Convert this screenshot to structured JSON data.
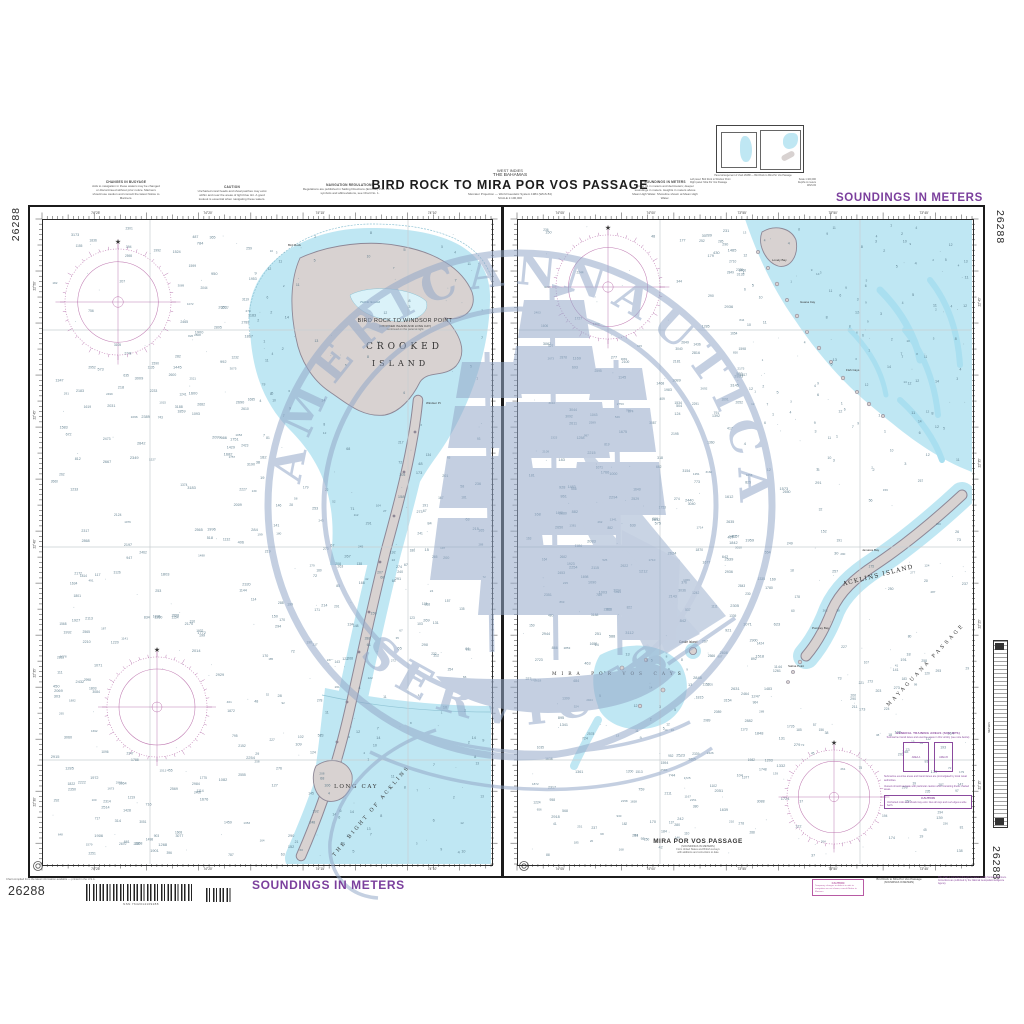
{
  "chart_number": "26288",
  "colors": {
    "accent": "#7b3f9d",
    "magenta": "#b85aa4",
    "roseline": "#c07bb2",
    "water": "#bfe7f3",
    "waterlight": "#daf2f9",
    "land": "#d8d2d1",
    "landedge": "#8d8796",
    "contour": "#8fc3d4",
    "sounding": "#4f7182",
    "wm": "#94a9c9",
    "graytext": "#555555"
  },
  "banner": {
    "soundings": "SOUNDINGS IN METERS"
  },
  "header": {
    "small1": "WEST INDIES",
    "small2": "THE BAHAMAS",
    "title": "BIRD ROCK TO MIRA POR VOS PASSAGE",
    "sub1": "Mercator Projection — World Geodetic System 1984 (WGS 84)",
    "sub2": "SCALE 1:100,000"
  },
  "notes_top": [
    {
      "title": "CHANGES IN BUOYAGE",
      "body": "Aids to navigation in these waters may be changed or discontinued without prior notice. Mariners should use caution and consult the latest Notice to Mariners."
    },
    {
      "title": "CAUTION",
      "body": "Uncharted coral heads and shoal patches may exist within and near the areas of light blue tint. A good lookout is essential when navigating these waters."
    },
    {
      "title": "NAVIGATION REGULATIONS",
      "body": "Regulations are published in Sailing Directions (Enroute) Pub. 147. For symbols and abbreviations, see Chart No. 1."
    },
    {
      "title": "SOUNDINGS IN METERS",
      "body": "Under 31 in meters and decimeters; deeper soundings in meters. Heights in meters above Mean High Water. Shoreline shown at Mean High Water."
    }
  ],
  "inset": {
    "line1": "Panel arrangement of chart 26288 — Bird Rock to Mira Por Vos Passage",
    "colL1": "Left panel: Bird Rock to Windsor Point",
    "colL2": "Right panel: Mira Por Vos Passage",
    "colR1": "Scale 1:100,000",
    "colR2": "Depths in meters",
    "colR3": "WGS 84"
  },
  "left_panel": {
    "inset_title": "BIRD ROCK TO WINDSOR POINT",
    "inset_sub1": "(CROOKED ISLAND AND LONG CAY)",
    "inset_sub2": "Continued on the panel at right",
    "crooked1": "CROOKED",
    "crooked2": "ISLAND",
    "turtle": "Turtle Sound",
    "bird_rock": "Bird Rock",
    "windsor": "Windsor Pt",
    "long_cay": "LONG CAY",
    "bight": "THE BIGHT OF ACKLINS"
  },
  "right_panel": {
    "title": "MIRA POR VOS PASSAGE",
    "sub1": "(SOUNDINGS IN METERS)",
    "sub2": "From United States and British surveys",
    "sub3": "with additions and corrections to date",
    "acklins": "ACKLINS ISLAND",
    "castle": "Castle Island",
    "mira_cays": "MIRA POR VOS CAYS",
    "mayaguana": "MAYAGUANA PASSAGE",
    "lovely": "Lovely Bay",
    "guana": "Guana Cay",
    "fish": "Fish Cays",
    "jamaica": "Jamaica Bay",
    "pompey": "Pompey Bay",
    "salina": "Salina Point"
  },
  "margin_right": {
    "h1": "GENERAL TRAINING AREAS (SUB OPS)",
    "h2": "Submarine transit lanes and exercise areas in this vicinity (see note below)",
    "box1": "AREA A",
    "box2": "AREA B",
    "para1": "Submarine exercise areas and transit lanes are promulgated by local naval authorities.",
    "para2": "Vessels should navigate with particular caution when transiting these charted areas.",
    "caution_title": "CAUTION",
    "caution_body": "Uncharted rocks and shoals may exist. Give all cays and reef edges a wide berth."
  },
  "scale_strip": {
    "label": "METERS"
  },
  "grid": {
    "left_top": [
      "74°25'",
      "74°20'",
      "74°15'",
      "74°10'"
    ],
    "left_side": [
      "22°50'",
      "22°45'",
      "22°40'",
      "22°35'",
      "22°30'"
    ],
    "right_top": [
      "74°05'",
      "74°00'",
      "73°55'",
      "73°50'",
      "73°45'"
    ],
    "right_side": [
      "22°45'",
      "22°35'",
      "22°25'",
      "22°15'"
    ]
  },
  "footer": {
    "tiny": "Chart compiled from the latest information available — printed in the U.S.A.",
    "number": "26288",
    "barcode_caption": "NSN 7642014109288",
    "caution_title": "CAUTION",
    "caution_body": "Temporary changes or defects in aids to navigation are not shown; consult Notice to Mariners.",
    "center1": "Bird Rock to Mira Por Vos Passage",
    "center2": "(SOUNDINGS IN METERS)",
    "right_note": "This chart is corrected through the latest weekly Notice to Mariners. Corrections are published by the National Geospatial-Intelligence Agency."
  },
  "watermark": {
    "word1": "AMERICAN",
    "word2": "NAUTICAL",
    "word3": "SERVICES"
  }
}
